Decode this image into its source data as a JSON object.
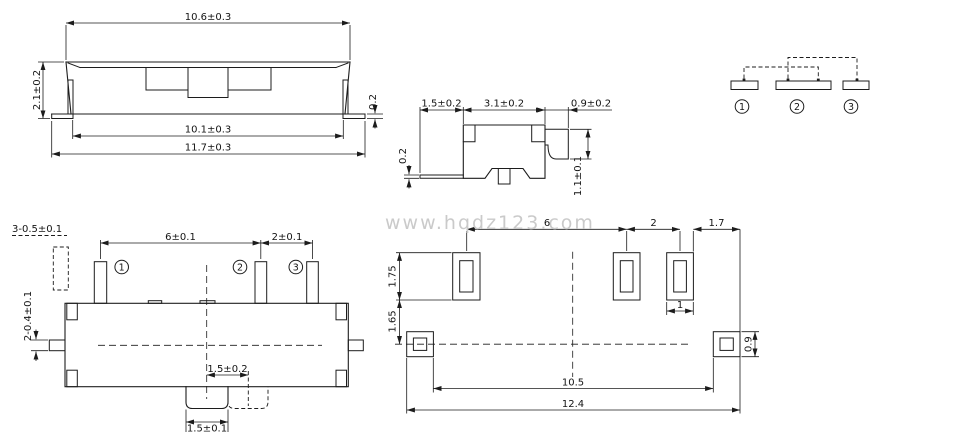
{
  "watermark": "www.hqdz123.com",
  "views": {
    "side": {
      "dims": {
        "cover_width": "10.6±0.3",
        "height": "2.1±0.2",
        "foot_thickness": "0.2",
        "pin_span": "10.1±0.3",
        "overall_width": "11.7±0.3"
      }
    },
    "end": {
      "dims": {
        "foot_len": "1.5±0.2",
        "body_depth": "3.1±0.2",
        "pin_len": "0.9±0.2",
        "foot_thickness": "0.2",
        "pin_height": "1.1±0.1"
      }
    },
    "schematic": {
      "terminals": [
        "1",
        "2",
        "3"
      ]
    },
    "top": {
      "dims": {
        "pin_spec": "3-0.5±0.1",
        "pitch_1_2": "6±0.1",
        "pitch_2_3": "2±0.1",
        "side_pin_spec": "2-0.4±0.1",
        "travel": "1.5±0.2",
        "knob_width": "1.5±0.1"
      },
      "terminals": [
        "1",
        "2",
        "3"
      ]
    },
    "pcb": {
      "dims": {
        "pitch_1_2": "6",
        "pitch_2_3": "2",
        "edge_margin": "1.7",
        "pad_height": "1.75",
        "pad_gap": "1.65",
        "pad_width": "1",
        "side_pad_height": "0.9",
        "inner_span": "10.5",
        "overall_span": "12.4"
      }
    }
  }
}
